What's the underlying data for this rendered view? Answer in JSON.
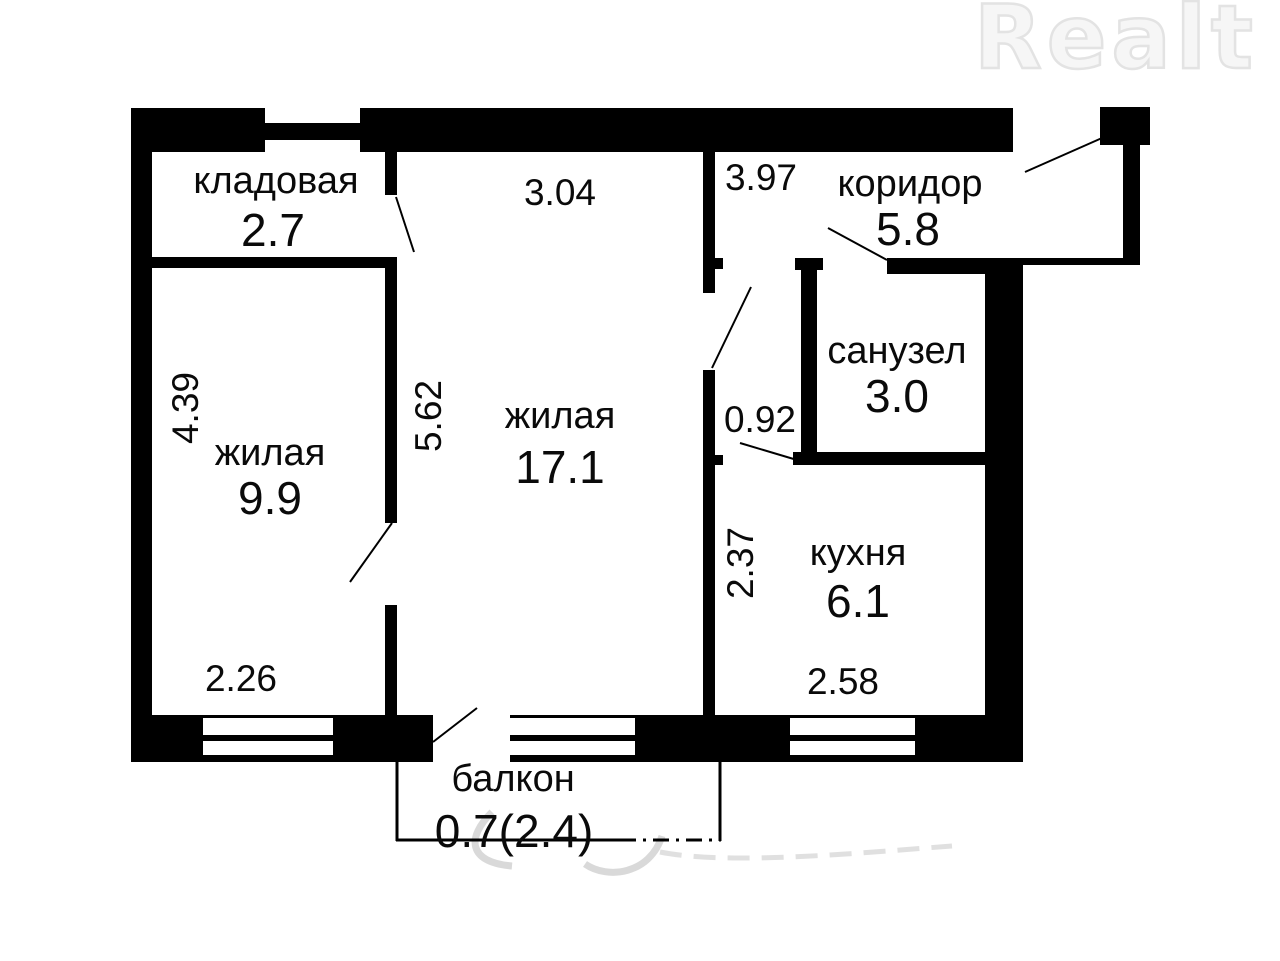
{
  "page": {
    "watermark_logo": "Realt"
  },
  "plan": {
    "rooms": [
      {
        "id": "kladovaya",
        "name": "кладовая",
        "area": "2.7"
      },
      {
        "id": "zhilaya-1",
        "name": "жилая",
        "area": "9.9"
      },
      {
        "id": "zhilaya-2",
        "name": "жилая",
        "area": "17.1"
      },
      {
        "id": "koridor",
        "name": "коридор",
        "area": "5.8"
      },
      {
        "id": "sanuzel",
        "name": "санузел",
        "area": "3.0"
      },
      {
        "id": "kuhnya",
        "name": "кухня",
        "area": "6.1"
      },
      {
        "id": "balkon",
        "name": "балкон",
        "area": "0.7(2.4)"
      }
    ],
    "dimensions": {
      "zhilaya2_width": "3.04",
      "koridor_width": "3.97",
      "zhilaya1_height": "4.39",
      "zhilaya2_height": "5.62",
      "nook_width": "0.92",
      "kuhnya_height": "2.37",
      "zhilaya1_width": "2.26",
      "kuhnya_width": "2.58"
    },
    "colors": {
      "wall": "#000000",
      "text": "#0a0a0a",
      "background": "#ffffff",
      "watermark_logo": "#ededed",
      "watermark_script": "#cccccc"
    }
  }
}
